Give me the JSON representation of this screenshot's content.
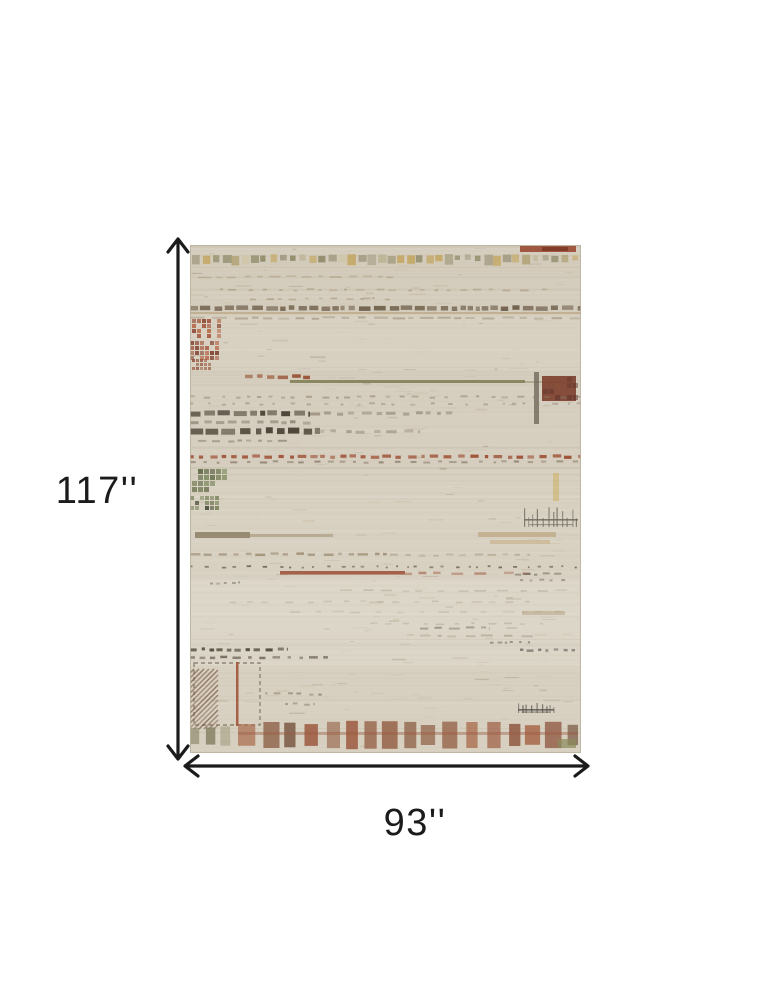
{
  "page": {
    "background": "#ffffff"
  },
  "diagram": {
    "type": "product-dimension-diagram",
    "height_label": "117''",
    "width_label": "93''",
    "arrow_color": "#1b1b1b",
    "label_color": "#1b1b1b",
    "rug": {
      "description": "beige abstract striped area rug",
      "base": "#d8d1c2",
      "edge": "#b8b09c",
      "top_tint": "#c2b8a2",
      "light_tint": "#e7e3d7",
      "striation_colors": [
        "#c7bfae",
        "#e6e1d4",
        "#b9ae98",
        "#cfc8b8",
        "#d2c9b5"
      ],
      "fleck_colors": [
        "#a8997e",
        "#8f8268",
        "#c0b296",
        "#7c7054",
        "#b5a482"
      ],
      "features": [
        {
          "t": "rect",
          "x": 330,
          "y": 1,
          "w": 56,
          "h": 6,
          "f": "#9a4b33",
          "o": 0.9
        },
        {
          "t": "rect",
          "x": 352,
          "y": 2,
          "w": 26,
          "h": 4,
          "f": "#7e3a28",
          "o": 0.9
        },
        {
          "t": "sqrow",
          "x": 3,
          "y": 10,
          "n": 40,
          "s": 9.7,
          "z": 7,
          "cols": [
            "#b3a478",
            "#8f8a68",
            "#c2a35a",
            "#a39a82",
            "#bdb394",
            "#97906f",
            "#cfc5a8"
          ],
          "o": 0.92
        },
        {
          "t": "dash",
          "x": 8,
          "y": 31,
          "w": 200,
          "h": 1.6,
          "f": "#a8977a",
          "o": 0.5,
          "d": [
            9,
            7
          ]
        },
        {
          "t": "dash",
          "x": 30,
          "y": 44,
          "w": 330,
          "h": 1.8,
          "f": "#9a8a6e",
          "o": 0.45,
          "d": [
            6,
            9
          ]
        },
        {
          "t": "dash",
          "x": 60,
          "y": 53,
          "w": 140,
          "h": 1.6,
          "f": "#8a7a5e",
          "o": 0.4,
          "d": [
            5,
            7
          ]
        },
        {
          "t": "dash",
          "x": 0,
          "y": 61,
          "w": 391,
          "h": 4.5,
          "f": "#6e5f4a",
          "o": 0.8,
          "d": [
            8,
            3
          ]
        },
        {
          "t": "rect",
          "x": 0,
          "y": 67,
          "w": 391,
          "h": 2,
          "f": "#b49a72",
          "o": 0.55
        },
        {
          "t": "dash",
          "x": 0,
          "y": 72,
          "w": 391,
          "h": 2,
          "f": "#8a7a64",
          "o": 0.4,
          "d": [
            10,
            6
          ]
        },
        {
          "t": "chk",
          "x": 2,
          "y": 74,
          "w": 30,
          "h": 20,
          "c": 5,
          "cols": [
            "#a04e34",
            "#8a4430",
            "#b86a4a"
          ],
          "o": 0.92
        },
        {
          "t": "chk",
          "x": 0,
          "y": 96,
          "w": 26,
          "h": 16,
          "c": 5,
          "cols": [
            "#a04e34",
            "#7e3a28",
            "#b86a4a"
          ],
          "o": 0.88
        },
        {
          "t": "chk",
          "x": 2,
          "y": 114,
          "w": 20,
          "h": 9,
          "c": 4,
          "cols": [
            "#9a5a40",
            "#8a4430"
          ],
          "o": 0.8
        },
        {
          "t": "dash",
          "x": 55,
          "y": 130,
          "w": 65,
          "h": 3.5,
          "f": "#9c5a3c",
          "o": 0.9,
          "d": [
            7,
            4
          ]
        },
        {
          "t": "rect",
          "x": 100,
          "y": 135,
          "w": 235,
          "h": 3,
          "f": "#7c7b50",
          "o": 0.85
        },
        {
          "t": "rect",
          "x": 335,
          "y": 136,
          "w": 40,
          "h": 2,
          "f": "#7c7b50",
          "o": 0.4
        },
        {
          "t": "rect",
          "x": 344,
          "y": 127,
          "w": 5,
          "h": 52,
          "f": "#6b6257",
          "o": 0.75
        },
        {
          "t": "rect",
          "x": 352,
          "y": 131,
          "w": 34,
          "h": 25,
          "f": "#7e4434",
          "o": 0.95
        },
        {
          "t": "chk",
          "x": 353,
          "y": 132,
          "w": 32,
          "h": 23,
          "c": 6,
          "cols": [
            "#5e3328",
            "#8a4f3a"
          ],
          "o": 0.6
        },
        {
          "t": "dash",
          "x": 0,
          "y": 151,
          "w": 391,
          "h": 2,
          "f": "#8a7a64",
          "o": 0.45,
          "d": [
            5,
            9
          ]
        },
        {
          "t": "dash",
          "x": 0,
          "y": 158,
          "w": 391,
          "h": 2,
          "f": "#8a7a64",
          "o": 0.4,
          "d": [
            4,
            11
          ]
        },
        {
          "t": "dash",
          "x": 0,
          "y": 166,
          "w": 120,
          "h": 5,
          "f": "#4f483a",
          "o": 0.85,
          "d": [
            9,
            3
          ]
        },
        {
          "t": "dash",
          "x": 120,
          "y": 167,
          "w": 150,
          "h": 3,
          "f": "#6a5f4c",
          "o": 0.4,
          "d": [
            7,
            6
          ]
        },
        {
          "t": "dash",
          "x": 0,
          "y": 176,
          "w": 125,
          "h": 3,
          "f": "#6a5f4c",
          "o": 0.5,
          "d": [
            6,
            5
          ]
        },
        {
          "t": "dash",
          "x": 0,
          "y": 183,
          "w": 130,
          "h": 6,
          "f": "#4f483a",
          "o": 0.88,
          "d": [
            10,
            4
          ]
        },
        {
          "t": "dash",
          "x": 130,
          "y": 185,
          "w": 100,
          "h": 3,
          "f": "#6a5f4c",
          "o": 0.35,
          "d": [
            8,
            7
          ]
        },
        {
          "t": "dash",
          "x": 8,
          "y": 195,
          "w": 90,
          "h": 2,
          "f": "#6a5f4c",
          "o": 0.45,
          "d": [
            6,
            6
          ]
        },
        {
          "t": "dash",
          "x": 0,
          "y": 210,
          "w": 391,
          "h": 3.2,
          "f": "#a0543a",
          "o": 0.85,
          "d": [
            6,
            5
          ]
        },
        {
          "t": "dash",
          "x": 0,
          "y": 216,
          "w": 391,
          "h": 2,
          "f": "#6a5a48",
          "o": 0.5,
          "d": [
            5,
            8
          ]
        },
        {
          "t": "chk",
          "x": 2,
          "y": 224,
          "w": 34,
          "h": 24,
          "c": 6,
          "cols": [
            "#6d7850",
            "#55603c",
            "#7d8a5e"
          ],
          "o": 0.9
        },
        {
          "t": "chk",
          "x": 0,
          "y": 251,
          "w": 30,
          "h": 14,
          "c": 5,
          "cols": [
            "#6d7850",
            "#3e4630",
            "#7d8a5e"
          ],
          "o": 0.85
        },
        {
          "t": "rect",
          "x": 363,
          "y": 228,
          "w": 6,
          "h": 28,
          "f": "#c9a84c",
          "o": 0.45
        },
        {
          "t": "grid",
          "x": 334,
          "y": 262,
          "w": 54,
          "h": 20,
          "f": "#6e6a60",
          "o": 0.85
        },
        {
          "t": "rect",
          "x": 5,
          "y": 287,
          "w": 55,
          "h": 6,
          "f": "#7e6f54",
          "o": 0.7
        },
        {
          "t": "rect",
          "x": 58,
          "y": 289,
          "w": 85,
          "h": 3,
          "f": "#9a8a6a",
          "o": 0.5
        },
        {
          "t": "rect",
          "x": 288,
          "y": 287,
          "w": 78,
          "h": 5,
          "f": "#b59a6e",
          "o": 0.55
        },
        {
          "t": "rect",
          "x": 300,
          "y": 295,
          "w": 60,
          "h": 4,
          "f": "#c2a878",
          "o": 0.5
        },
        {
          "t": "dash",
          "x": 0,
          "y": 308,
          "w": 200,
          "h": 2.5,
          "f": "#8a7558",
          "o": 0.55,
          "d": [
            7,
            6
          ]
        },
        {
          "t": "dash",
          "x": 200,
          "y": 309,
          "w": 140,
          "h": 2,
          "f": "#8a7558",
          "o": 0.3,
          "d": [
            6,
            8
          ]
        },
        {
          "t": "dash",
          "x": 0,
          "y": 321,
          "w": 391,
          "h": 1.8,
          "f": "#55503f",
          "o": 0.65,
          "d": [
            3,
            9
          ]
        },
        {
          "t": "rect",
          "x": 90,
          "y": 326,
          "w": 125,
          "h": 3.6,
          "f": "#9a4e35",
          "o": 0.85
        },
        {
          "t": "dash",
          "x": 215,
          "y": 327,
          "w": 125,
          "h": 2.5,
          "f": "#9a4e35",
          "o": 0.45,
          "d": [
            10,
            12
          ]
        },
        {
          "t": "dash",
          "x": 325,
          "y": 328,
          "w": 48,
          "h": 2,
          "f": "#6a6456",
          "o": 0.6,
          "d": [
            5,
            4
          ]
        },
        {
          "t": "dash",
          "x": 330,
          "y": 334,
          "w": 45,
          "h": 2,
          "f": "#6a6456",
          "o": 0.5,
          "d": [
            4,
            6
          ]
        },
        {
          "t": "dash",
          "x": 20,
          "y": 337,
          "w": 30,
          "h": 2,
          "f": "#6a6456",
          "o": 0.45,
          "d": [
            4,
            4
          ]
        },
        {
          "t": "dash",
          "x": 150,
          "y": 345,
          "w": 240,
          "h": 1.6,
          "f": "#8a7a64",
          "o": 0.25,
          "d": [
            8,
            10
          ]
        },
        {
          "t": "dash",
          "x": 40,
          "y": 356,
          "w": 300,
          "h": 1.6,
          "f": "#8a7a64",
          "o": 0.22,
          "d": [
            7,
            12
          ]
        },
        {
          "t": "dash",
          "x": 100,
          "y": 366,
          "w": 280,
          "h": 1.6,
          "f": "#8a7a64",
          "o": 0.2,
          "d": [
            9,
            11
          ]
        },
        {
          "t": "rect",
          "x": 332,
          "y": 366,
          "w": 43,
          "h": 4,
          "f": "#a89468",
          "o": 0.4
        },
        {
          "t": "dash",
          "x": 180,
          "y": 378,
          "w": 180,
          "h": 1.6,
          "f": "#8a7a64",
          "o": 0.25,
          "d": [
            6,
            10
          ]
        },
        {
          "t": "dash",
          "x": 230,
          "y": 382,
          "w": 70,
          "h": 2,
          "f": "#55504a",
          "o": 0.4,
          "d": [
            8,
            5
          ]
        },
        {
          "t": "dash",
          "x": 230,
          "y": 390,
          "w": 120,
          "h": 2,
          "f": "#7a6a55",
          "o": 0.3,
          "d": [
            8,
            8
          ]
        },
        {
          "t": "dash",
          "x": 300,
          "y": 396,
          "w": 40,
          "h": 2,
          "f": "#55504a",
          "o": 0.5,
          "d": [
            4,
            5
          ]
        },
        {
          "t": "dash",
          "x": 330,
          "y": 404,
          "w": 55,
          "h": 2.5,
          "f": "#55504a",
          "o": 0.6,
          "d": [
            5,
            4
          ]
        },
        {
          "t": "dash",
          "x": 0,
          "y": 403,
          "w": 98,
          "h": 3,
          "f": "#4f483a",
          "o": 0.85,
          "d": [
            5,
            4
          ]
        },
        {
          "t": "dash",
          "x": 0,
          "y": 411,
          "w": 140,
          "h": 2.5,
          "f": "#4f483a",
          "o": 0.6,
          "d": [
            6,
            6
          ]
        },
        {
          "t": "dbox",
          "x": 4,
          "y": 418,
          "w": 66,
          "h": 62,
          "f": "#7a6a55",
          "o": 0.75
        },
        {
          "t": "rect",
          "x": 46,
          "y": 417,
          "w": 2.5,
          "h": 64,
          "f": "#a0543a",
          "o": 0.9
        },
        {
          "t": "hatch",
          "x": 0,
          "y": 424,
          "w": 28,
          "h": 60,
          "s": 5,
          "f": "#7a5a44",
          "o": 0.75
        },
        {
          "t": "dash",
          "x": 75,
          "y": 448,
          "w": 60,
          "h": 2,
          "f": "#6a5a48",
          "o": 0.5,
          "d": [
            5,
            6
          ]
        },
        {
          "t": "dash",
          "x": 95,
          "y": 458,
          "w": 30,
          "h": 2,
          "f": "#6a5a48",
          "o": 0.4,
          "d": [
            4,
            5
          ]
        },
        {
          "t": "grid",
          "x": 328,
          "y": 458,
          "w": 36,
          "h": 10,
          "f": "#55504a",
          "o": 0.8
        },
        {
          "t": "band",
          "x": 48,
          "y": 477,
          "w": 340,
          "h": 26,
          "bw": 13,
          "g": 7,
          "cols": [
            "#9c5a40",
            "#8a4f38",
            "#a86a4c",
            "#7a5a44",
            "#9a6a50",
            "#8a5a40"
          ],
          "o": 0.88
        },
        {
          "t": "band",
          "x": 0,
          "y": 481,
          "w": 48,
          "h": 20,
          "bw": 9,
          "g": 6,
          "cols": [
            "#8a8468",
            "#9a9070",
            "#7a7458",
            "#a09a7c"
          ],
          "o": 0.7
        },
        {
          "t": "rect",
          "x": 48,
          "y": 487,
          "w": 340,
          "h": 3,
          "f": "#9c5a40",
          "o": 0.4
        },
        {
          "t": "rect",
          "x": 368,
          "y": 494,
          "w": 18,
          "h": 9,
          "f": "#8a8a5a",
          "o": 0.7
        }
      ]
    }
  }
}
